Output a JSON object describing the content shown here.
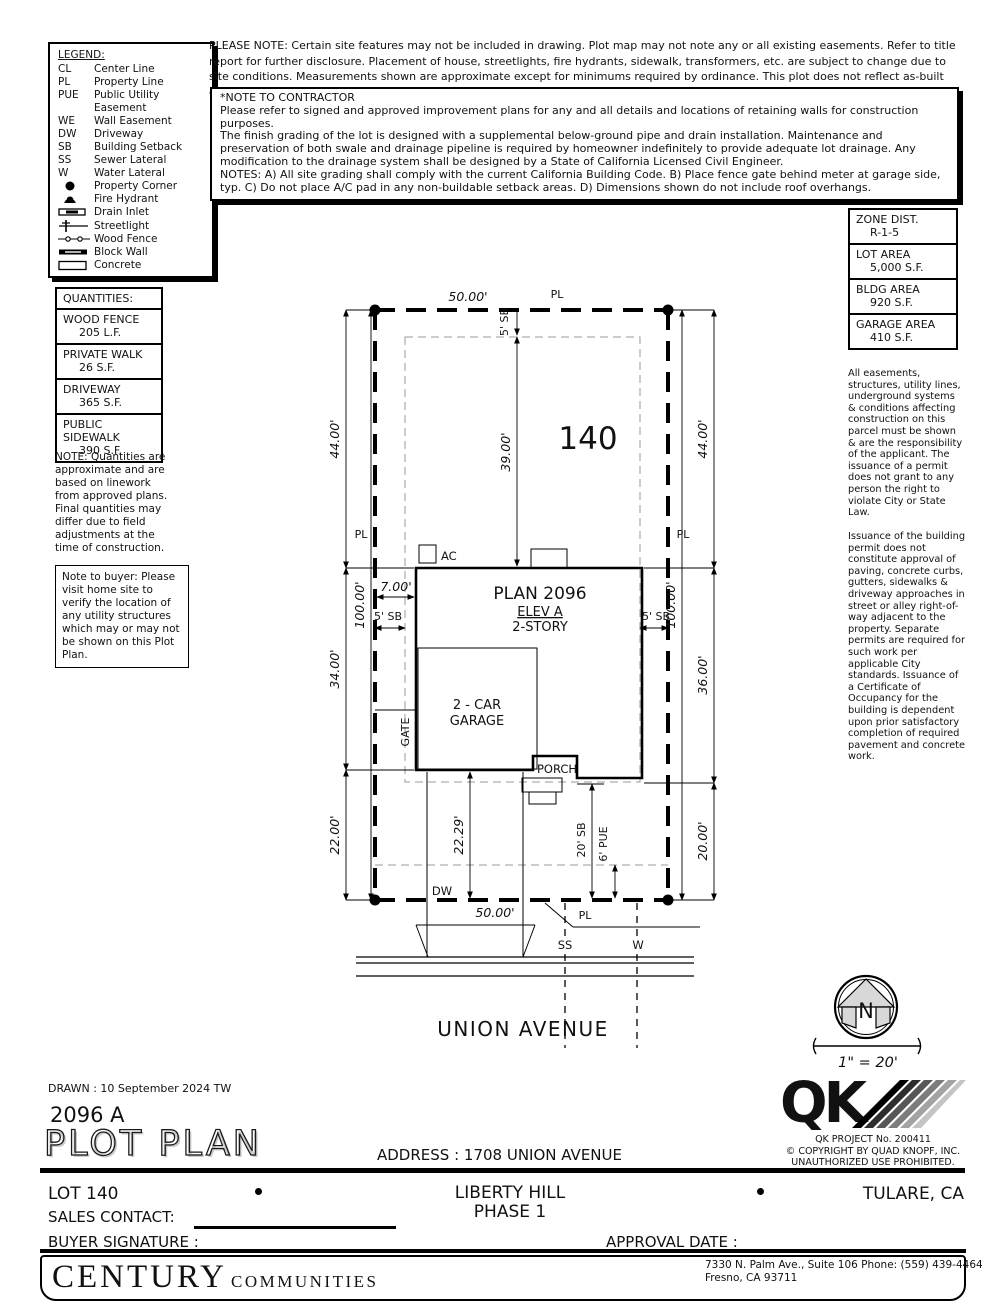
{
  "doc": {
    "please_note": "PLEASE NOTE:  Certain site features may not be included in drawing.  Plot map may not note any or all existing easements. Refer to title report for further disclosure.  Placement of house, streetlights, fire hydrants, sidewalk, transformers, etc. are subject to change due to site conditions.  Measurements shown are approximate except for minimums required by ordinance.  This plot does not reflect as-built conditions which may vary from this plan.",
    "contractor": {
      "title": "*NOTE TO CONTRACTOR",
      "p1": "Please refer to signed and approved improvement plans for any and all details and locations of retaining walls for construction purposes.",
      "p2": "The finish grading of the lot is designed with a supplemental below-ground pipe and drain installation.  Maintenance and preservation of both swale and drainage pipeline is required by homeowner indefinitely to provide adequate lot drainage.  Any modification to the drainage system shall be designed by a State of California Licensed Civil Engineer.",
      "p3": "NOTES:  A) All site grading shall comply with the current California Building Code.  B) Place fence gate behind meter at garage side, typ.  C) Do not place A/C pad in any non-buildable setback areas.  D) Dimensions shown do not include roof overhangs."
    },
    "buyer_note": "Note to buyer: Please visit home site to verify the location of any utility structures which may or may not be shown on this Plot Plan.",
    "right_note1": "All easements, structures, utility lines, underground systems & conditions affecting construction on this parcel must be shown & are the responsibility of the applicant. The issuance of a permit does not grant to any person the right to violate City or State Law.",
    "right_note2": "Issuance of the building permit does not constitute approval of paving, concrete curbs, gutters, sidewalks & driveway approaches in street or alley right-of-way adjacent to the property. Separate permits are required for such work per applicable City standards. Issuance of a Certificate of Occupancy for the building is dependent upon prior satisfactory completion of required pavement and concrete work."
  },
  "legend": {
    "title": "LEGEND:",
    "items": [
      {
        "abbr": "CL",
        "label": "Center Line"
      },
      {
        "abbr": "PL",
        "label": "Property Line"
      },
      {
        "abbr": "PUE",
        "label": "Public Utility Easement"
      },
      {
        "abbr": "WE",
        "label": "Wall Easement"
      },
      {
        "abbr": "DW",
        "label": "Driveway"
      },
      {
        "abbr": "SB",
        "label": "Building Setback"
      },
      {
        "abbr": "SS",
        "label": "Sewer Lateral"
      },
      {
        "abbr": "W",
        "label": "Water Lateral"
      },
      {
        "icon": "property-corner",
        "label": "Property Corner"
      },
      {
        "icon": "fire-hydrant",
        "label": "Fire Hydrant"
      },
      {
        "icon": "drain-inlet",
        "label": "Drain Inlet"
      },
      {
        "icon": "streetlight",
        "label": "Streetlight"
      },
      {
        "icon": "wood-fence",
        "label": "Wood Fence"
      },
      {
        "icon": "block-wall",
        "label": "Block Wall"
      },
      {
        "icon": "concrete",
        "label": "Concrete"
      }
    ]
  },
  "zone": {
    "rows": [
      {
        "label": "ZONE DIST.",
        "value": "R-1-5"
      },
      {
        "label": "LOT AREA",
        "value": "5,000 S.F."
      },
      {
        "label": "BLDG AREA",
        "value": "920 S.F."
      },
      {
        "label": "GARAGE AREA",
        "value": "410 S.F."
      }
    ]
  },
  "quantities": {
    "title": "QUANTITIES:",
    "rows": [
      {
        "label": "WOOD FENCE",
        "value": "205 L.F."
      },
      {
        "label": "PRIVATE WALK",
        "value": "26 S.F."
      },
      {
        "label": "DRIVEWAY",
        "value": "365 S.F."
      },
      {
        "label": "PUBLIC SIDEWALK",
        "value": "390 S.F."
      }
    ],
    "note": "NOTE: Quantities are approximate and are based on linework from approved plans.  Final quantities may differ due to field adjustments at the time of construction."
  },
  "plot": {
    "dims": {
      "d50_top": "50.00'",
      "d50_bottom": "50.00'",
      "d44": "44.00'",
      "d34": "34.00'",
      "d22": "22.00'",
      "d100": "100.00'",
      "d36": "36.00'",
      "d20": "20.00'",
      "d39": "39.00'",
      "d2229": "22.29'",
      "d7": "7.00'",
      "sb5": "5' SB",
      "sb20": "20' SB",
      "pue6": "6' PUE"
    },
    "labels": {
      "pl": "PL",
      "lot": "140",
      "ac": "AC",
      "plan": "PLAN 2096",
      "elev": "ELEV A",
      "story": "2-STORY",
      "garage1": "2 - CAR",
      "garage2": "GARAGE",
      "porch": "PORCH",
      "gate": "GATE",
      "dw": "DW",
      "ss": "SS",
      "w": "W",
      "street": "UNION AVENUE"
    }
  },
  "compass": {
    "n": "N",
    "scale": "1\" = 20'"
  },
  "footer": {
    "drawn": "DRAWN :  10 September 2024   TW",
    "plan_code": "2096 A",
    "sheet_title": "PLOT PLAN",
    "address": "ADDRESS :  1708 UNION AVENUE",
    "qk_project": "QK PROJECT No. 200411",
    "qk_copyright": "©   COPYRIGHT BY QUAD KNOPF, INC.",
    "qk_prohibited": "UNAUTHORIZED USE PROHIBITED.",
    "lot": "LOT 140",
    "community": "LIBERTY HILL",
    "phase": "PHASE 1",
    "city": "TULARE, CA",
    "sales_contact_label": "SALES CONTACT:",
    "buyer_signature_label": "BUYER SIGNATURE :",
    "approval_date_label": "APPROVAL DATE :",
    "builder_name": "CENTURY",
    "builder_suffix": "COMMUNITIES",
    "builder_address1": "7330 N. Palm Ave., Suite 106    Phone:  (559) 439-4464",
    "builder_address2": "Fresno, CA  93711"
  }
}
